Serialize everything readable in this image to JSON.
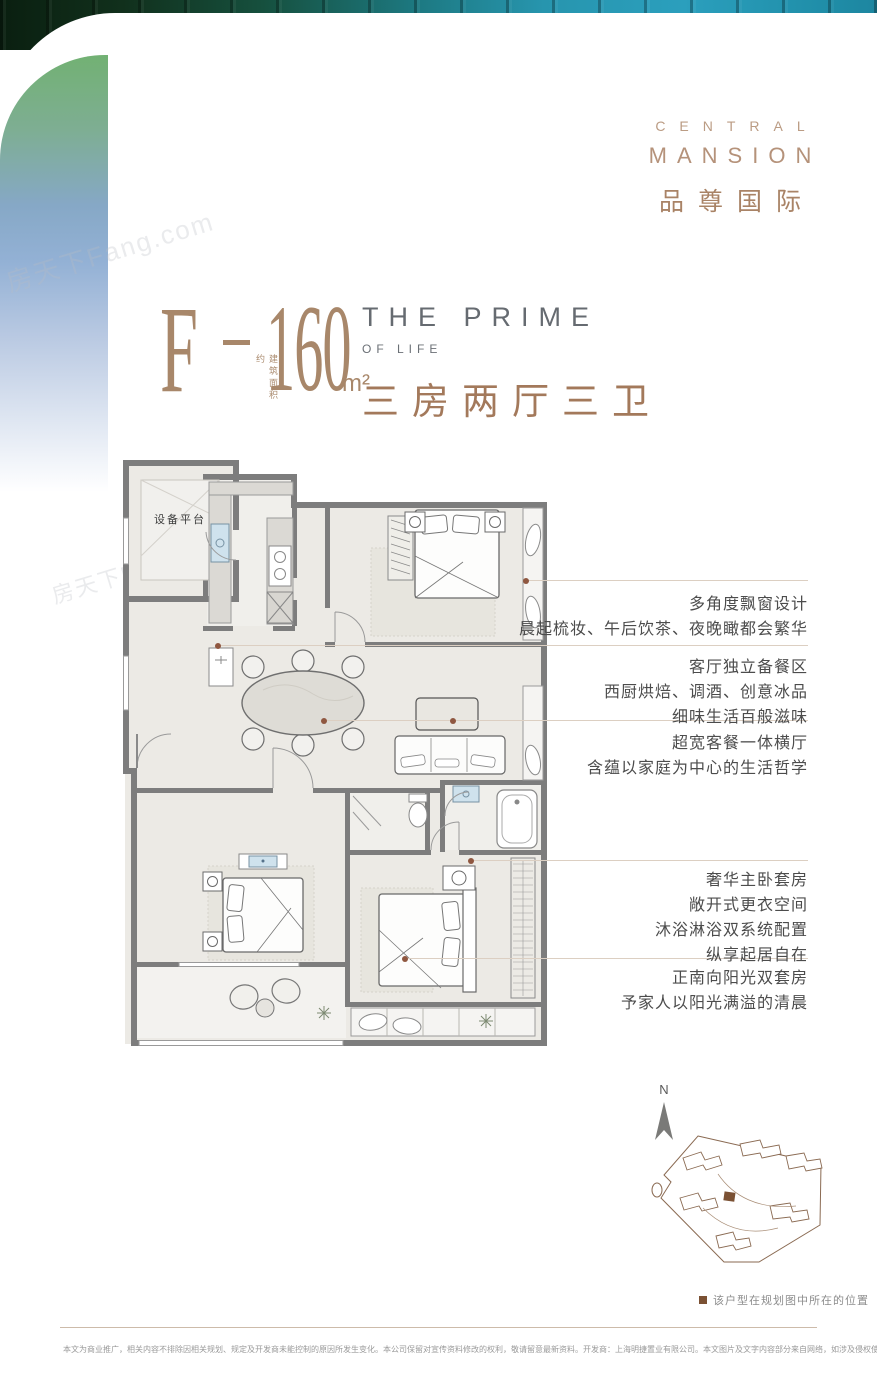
{
  "brand": {
    "line_en1": "CENTRAL",
    "line_en2": "MANSION",
    "line_cn": "品尊国际"
  },
  "headline": {
    "unit_letter": "F",
    "area_note": "建筑面积约",
    "area_value": "160",
    "area_unit": "m²",
    "en_title": "THE PRIME",
    "en_subtitle": "OF LIFE",
    "cn_rooms": "三房两厅三卫"
  },
  "floorplan": {
    "room_label": "设备平台"
  },
  "annotations": [
    {
      "lines": [
        "多角度飘窗设计",
        "晨起梳妆、午后饮茶、夜晚瞰都会繁华"
      ]
    },
    {
      "lines": [
        "客厅独立备餐区",
        "西厨烘焙、调酒、创意冰品",
        "细味生活百般滋味"
      ]
    },
    {
      "lines": [
        "超宽客餐一体横厅",
        "含蕴以家庭为中心的生活哲学"
      ]
    },
    {
      "lines": [
        "奢华主卧套房",
        "敞开式更衣空间",
        "沐浴淋浴双系统配置",
        "纵享起居自在"
      ]
    },
    {
      "lines": [
        "正南向阳光双套房",
        "予家人以阳光满溢的清晨"
      ]
    }
  ],
  "siteplan": {
    "north_label": "N",
    "caption": "该户型在规划图中所在的位置"
  },
  "watermark": "房天下Fang.com",
  "disclaimer": "本文为商业推广，相关内容不排除因相关规划、规定及开发商未能控制的原因所发生变化。本公司保留对宣传资料修改的权利，敬请留意最新资料。开发商：上海明捷置业有限公司。本文图片及文字内容部分来自网络，如涉及侵权使用，请版权所有人与我司联系，我司将尽快删除相关内容",
  "colors": {
    "brand_tan": "#b5927a",
    "headline_brown": "#a8876a",
    "rooms_brown": "#a3795b",
    "en_gray": "#666b71",
    "wall_gray": "#7d7d7d",
    "leader_dot_brown": "#8f5740",
    "siteplan_brown": "#8a6a52",
    "fixture_blue": "#cfe2ed",
    "ribbon_green": "#72b173",
    "ribbon_blue": "#93b1d5"
  }
}
